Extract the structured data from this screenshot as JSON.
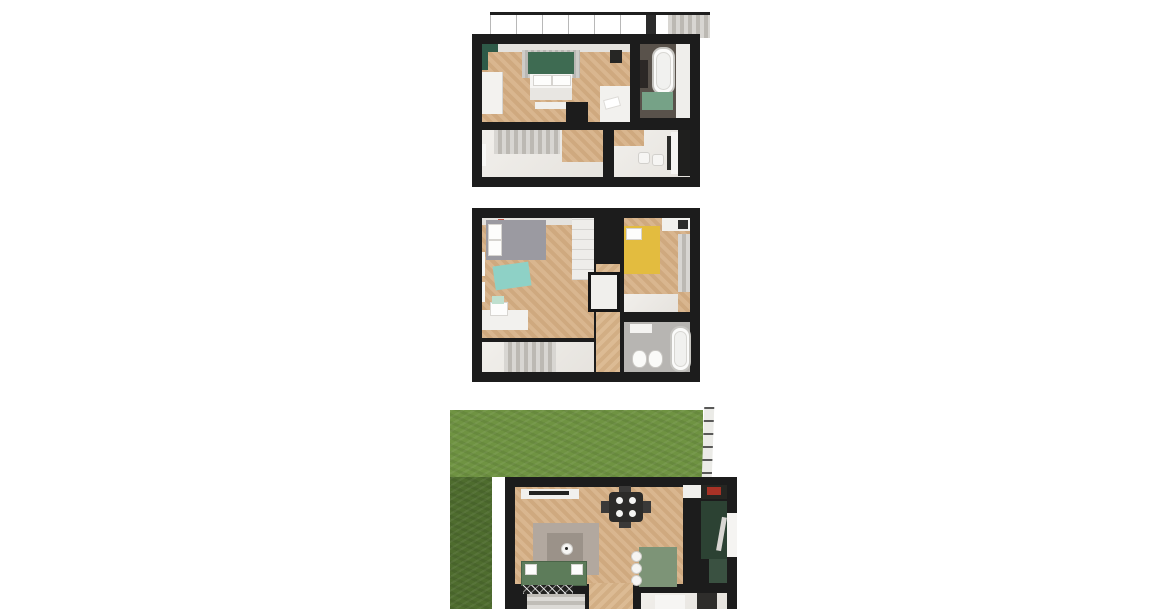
{
  "scene": {
    "kind": "3d-floor-plan-renders",
    "floors": [
      {
        "id": "top-floor",
        "rooms": [
          "bedroom",
          "bathroom",
          "stair-hall",
          "study"
        ],
        "features": [
          "roof-terrace-strip",
          "green-headboard-bed",
          "bathtub",
          "green-bath-mat",
          "stair-slat-screen",
          "desk-with-stools"
        ]
      },
      {
        "id": "middle-floor",
        "rooms": [
          "bedroom-left",
          "bedroom-right",
          "corridor",
          "bathroom",
          "stair-hall"
        ],
        "features": [
          "gray-bed",
          "teal-rug",
          "yellow-bed",
          "closet",
          "bathtub",
          "two-toilets",
          "stairs"
        ]
      },
      {
        "id": "ground-floor",
        "rooms": [
          "living-room",
          "dining-area",
          "kitchen",
          "hallway",
          "stairs",
          "bottom-room"
        ],
        "outdoor": [
          "lawn",
          "fence",
          "shaded-lawn-strip"
        ],
        "features": [
          "tv-cabinet",
          "dining-table-four-chairs",
          "gray-rug",
          "coffee-table",
          "green-corner-sofa",
          "green-kitchen-island",
          "dark-green-kitchen-wall",
          "zigzag-doormat"
        ]
      }
    ]
  },
  "palette": {
    "background": "#ffffff",
    "wall": "#1c1c1c",
    "wood_light": "#d9b68f",
    "wood_dark": "#cfa97f",
    "floor_white": "#efede9",
    "roof_gray": "#d6d6d4",
    "bed_green": "#3e6b52",
    "curtain_green": "#2e5a48",
    "bath_mat_green": "#76a287",
    "bath_floor_dark": "#59524b",
    "bed_gray": "#9b9aa1",
    "rug_teal": "#8ed1c6",
    "bed_yellow": "#e3bc3f",
    "chair_mint": "#bfe0cf",
    "bath_floor_gray": "#b7b5b2",
    "grass": "#6f9342",
    "grass_shade": "#4e6c2e",
    "fence": "#ebebe7",
    "sofa_green": "#5d7c5a",
    "island_green": "#7d9477",
    "kitchen_green": "#2c4233",
    "kitchen_green_light": "#3a5141",
    "rug_gray": "#b2a89f",
    "table_dark": "#2c2b29",
    "stove_red": "#a83226"
  }
}
